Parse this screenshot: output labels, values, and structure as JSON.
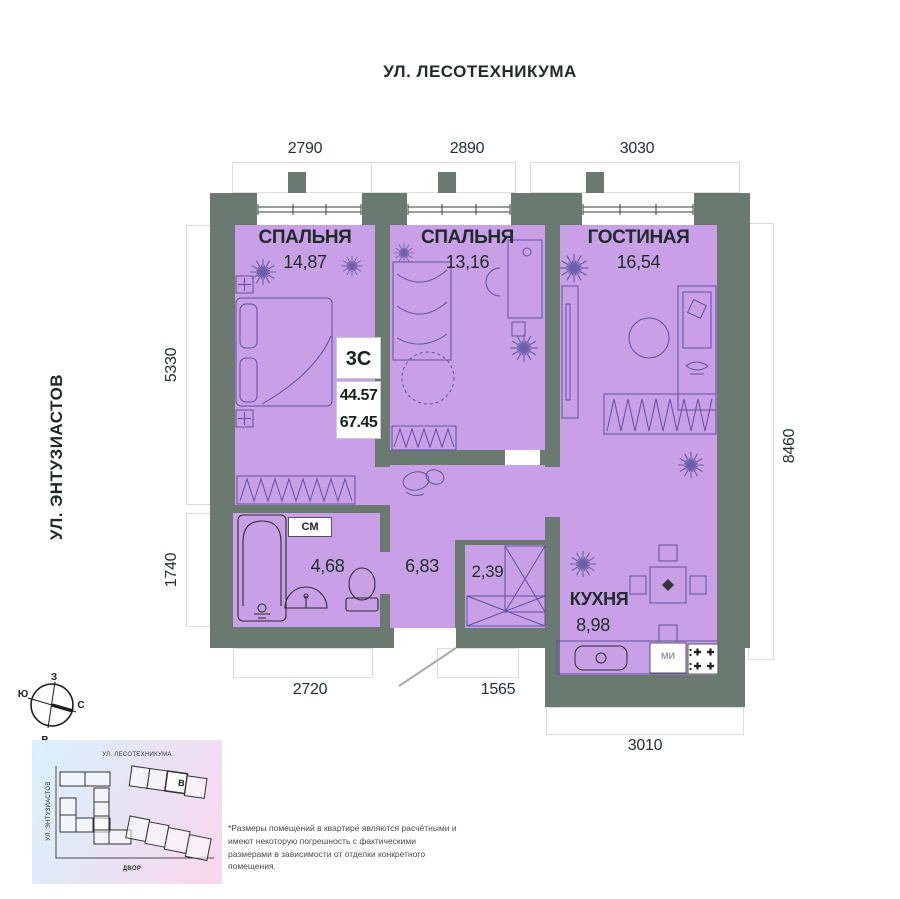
{
  "streets": {
    "top": "УЛ. ЛЕСОТЕХНИКУМА",
    "left": "УЛ. ЭНТУЗИАСТОВ"
  },
  "dimensions": {
    "top": [
      "2790",
      "2890",
      "3030"
    ],
    "left": [
      "5330",
      "1740"
    ],
    "right": [
      "8460"
    ],
    "bottom": [
      "2720",
      "1565"
    ],
    "bottom_kitchen": "3010"
  },
  "unit": {
    "type": "3С",
    "area_living": "44.57",
    "area_total": "67.45"
  },
  "rooms": {
    "bedroom1": {
      "name": "СПАЛЬНЯ",
      "area": "14,87"
    },
    "bedroom2": {
      "name": "СПАЛЬНЯ",
      "area": "13,16"
    },
    "living": {
      "name": "ГОСТИНАЯ",
      "area": "16,54"
    },
    "kitchen": {
      "name": "КУХНЯ",
      "area": "8,98"
    },
    "bathroom": {
      "area": "4,68",
      "tag": "СМ"
    },
    "hall": {
      "area": "6,83"
    },
    "closet": {
      "area": "2,39"
    }
  },
  "appliances": {
    "washer": "МИ"
  },
  "compass": {
    "top": "З",
    "left": "Ю",
    "right": "С",
    "bottom": "В"
  },
  "minimap": {
    "street_top": "УЛ. ЛЕСОТЕХНИКУМА",
    "street_left": "УЛ. ЭНТУЗИАСТОВ",
    "yard": "ДВОР",
    "building_label": "В"
  },
  "disclaimer": "*Размеры помещений в квартире являются расчётными и имеют некоторую погрешность с фактическими размерами в зависимости от отделки конкретного помещения.",
  "colors": {
    "wall": "#6b7a70",
    "room": "#c9a0e8",
    "text": "#1e2a28"
  }
}
